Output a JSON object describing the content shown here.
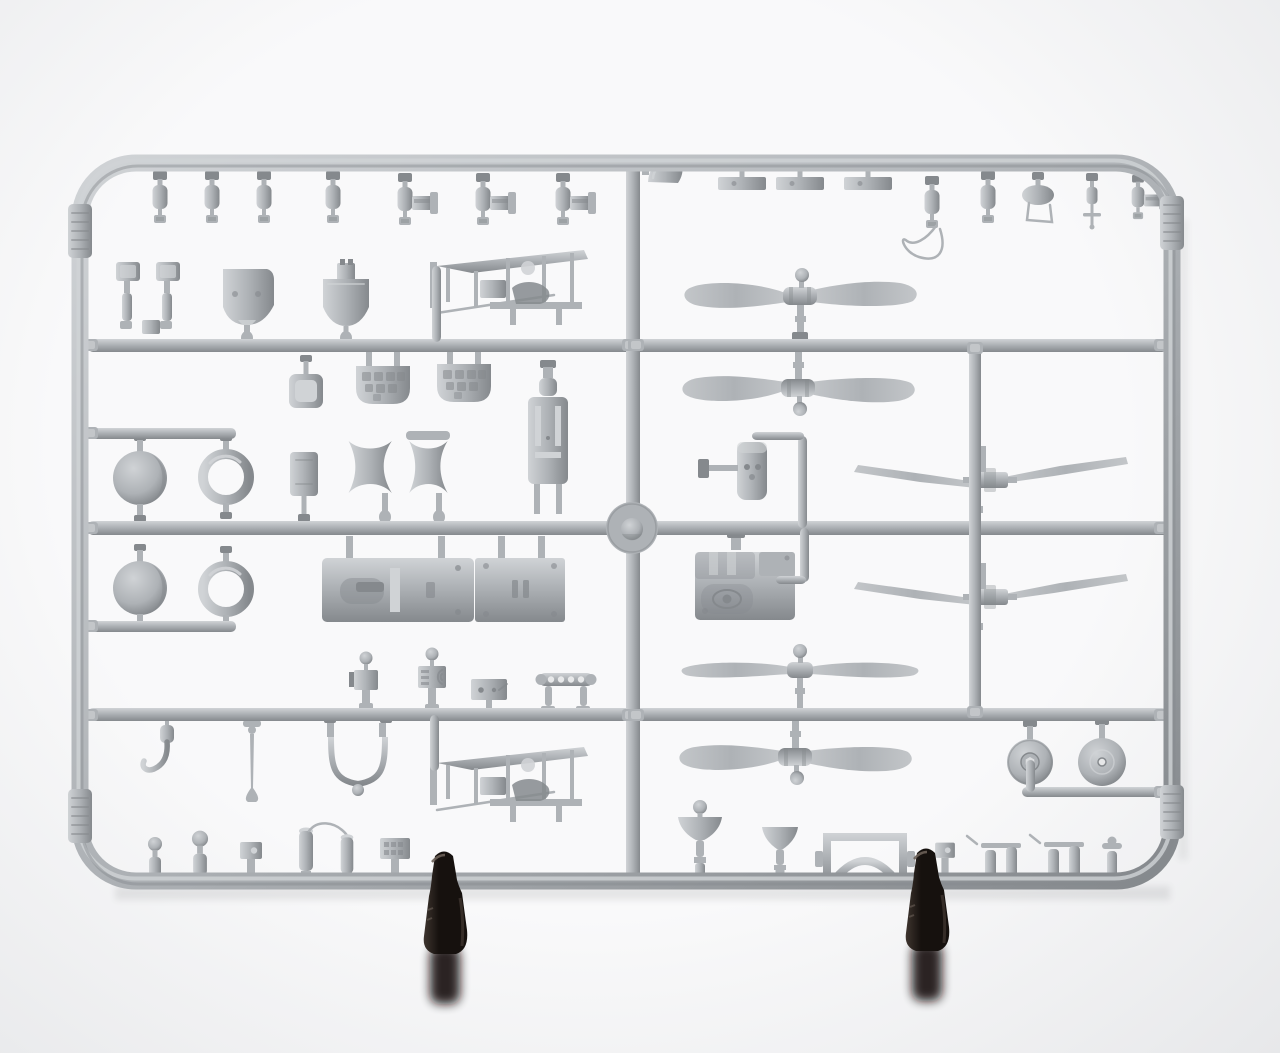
{
  "meta": {
    "description": "Photograph of a light-gray injection-molded plastic model aircraft sprue (parts frame) on a white background, held upright by two dark display clips at the bottom. The rectangular runner frame is divided by a central vertical runner and three horizontal runners; it carries propellers, spinner domes, cowling rings, bulkheads, instrument panels, an engine block, wheels, seats, guns and many small fittings."
  },
  "colors": {
    "background": "#f9f9fa",
    "vignette": "#e7e8ea",
    "plastic": "#aeb2b6",
    "plastic_light": "#d0d3d6",
    "plastic_dark": "#85898d",
    "plastic_deep": "#6e7276",
    "blade_light": "#c3c6c9",
    "clip_dark": "#16110e",
    "clip_mid": "#3e352f",
    "clip_light": "#6b6058",
    "shadow": "#3a3d40"
  },
  "inventory": [
    {
      "part": "small cylindrical fittings / pumps (top and bottom rows)",
      "count": 22
    },
    {
      "part": "machine guns with breech blocks",
      "count": 4
    },
    {
      "part": "windscreen",
      "count": 1
    },
    {
      "part": "flat mounting plates",
      "count": 3
    },
    {
      "part": "crew seat pair and seat backs",
      "count": 3
    },
    {
      "part": "firewall bulkheads",
      "count": 2
    },
    {
      "part": "instrument panels (textured)",
      "count": 2
    },
    {
      "part": "radiator panel stack",
      "count": 1
    },
    {
      "part": "spinner domes (balls)",
      "count": 2
    },
    {
      "part": "cowling rings",
      "count": 2
    },
    {
      "part": "cowl saddle halves with handle",
      "count": 1
    },
    {
      "part": "fuselage decking halves",
      "count": 2
    },
    {
      "part": "fuselage side girder frames",
      "count": 2
    },
    {
      "part": "engine block",
      "count": 1
    },
    {
      "part": "two-blade propellers (paddle type)",
      "count": 3
    },
    {
      "part": "two-blade propellers (slender pointed type)",
      "count": 2
    },
    {
      "part": "two-blade propeller (straight slim type)",
      "count": 1
    },
    {
      "part": "disc wheels",
      "count": 2
    },
    {
      "part": "venturi funnels",
      "count": 2
    },
    {
      "part": "arched bracket frame",
      "count": 1
    },
    {
      "part": "control stick, U-bracket, hook lever",
      "count": 3
    },
    {
      "part": "embossed frame tabs",
      "count": 4
    },
    {
      "part": "black display clips",
      "count": 2
    }
  ],
  "sprue": {
    "frame": {
      "x": 80,
      "y": 163,
      "width": 1092,
      "height": 718,
      "corner_radius": 56,
      "tube_width": 17
    },
    "runners": [
      {
        "x": 88,
        "y": 339,
        "w": 545,
        "h": 13,
        "o": "h"
      },
      {
        "x": 633,
        "y": 339,
        "w": 534,
        "h": 13,
        "o": "h"
      },
      {
        "x": 88,
        "y": 521,
        "w": 1082,
        "h": 14,
        "o": "h"
      },
      {
        "x": 88,
        "y": 708,
        "w": 545,
        "h": 13,
        "o": "h"
      },
      {
        "x": 633,
        "y": 708,
        "w": 534,
        "h": 13,
        "o": "h"
      },
      {
        "x": 626,
        "y": 166,
        "w": 14,
        "h": 716,
        "o": "v"
      },
      {
        "x": 969,
        "y": 345,
        "w": 12,
        "h": 372,
        "o": "v"
      },
      {
        "x": 88,
        "y": 428,
        "w": 148,
        "h": 11,
        "o": "h"
      },
      {
        "x": 88,
        "y": 621,
        "w": 148,
        "h": 11,
        "o": "h"
      },
      {
        "x": 1022,
        "y": 787,
        "w": 146,
        "h": 10,
        "o": "h"
      },
      {
        "x": 1026,
        "y": 760,
        "w": 9,
        "h": 32,
        "o": "v"
      },
      {
        "x": 798,
        "y": 436,
        "w": 9,
        "h": 92,
        "o": "v"
      },
      {
        "x": 752,
        "y": 432,
        "w": 52,
        "h": 8,
        "o": "h"
      },
      {
        "x": 800,
        "y": 528,
        "w": 9,
        "h": 54,
        "o": "v"
      },
      {
        "x": 776,
        "y": 576,
        "w": 30,
        "h": 8,
        "o": "h"
      },
      {
        "x": 432,
        "y": 266,
        "w": 9,
        "h": 76,
        "o": "v"
      },
      {
        "x": 430,
        "y": 715,
        "w": 9,
        "h": 56,
        "o": "v"
      }
    ],
    "gates": [
      {
        "x": 90,
        "y": 345
      },
      {
        "x": 630,
        "y": 345
      },
      {
        "x": 636,
        "y": 345
      },
      {
        "x": 1162,
        "y": 345
      },
      {
        "x": 90,
        "y": 528
      },
      {
        "x": 630,
        "y": 528
      },
      {
        "x": 636,
        "y": 528
      },
      {
        "x": 1162,
        "y": 528
      },
      {
        "x": 90,
        "y": 715
      },
      {
        "x": 630,
        "y": 715
      },
      {
        "x": 636,
        "y": 715
      },
      {
        "x": 1162,
        "y": 715
      },
      {
        "x": 975,
        "y": 348
      },
      {
        "x": 975,
        "y": 712
      },
      {
        "x": 90,
        "y": 433
      },
      {
        "x": 90,
        "y": 626
      },
      {
        "x": 1162,
        "y": 792
      }
    ],
    "placements": [
      {
        "s": "cylA",
        "name": "small-cylinder-part",
        "x": 160,
        "y": 197
      },
      {
        "s": "cylA",
        "name": "small-cylinder-part",
        "x": 212,
        "y": 197
      },
      {
        "s": "cylA",
        "name": "small-cylinder-part",
        "x": 264,
        "y": 197
      },
      {
        "s": "cylA",
        "name": "small-cylinder-part",
        "x": 333,
        "y": 197
      },
      {
        "s": "cylGun",
        "name": "machine-gun-part",
        "x": 405,
        "y": 199
      },
      {
        "s": "cylGun",
        "name": "machine-gun-part",
        "x": 483,
        "y": 199
      },
      {
        "s": "cylGun",
        "name": "machine-gun-part",
        "x": 563,
        "y": 199
      },
      {
        "s": "windscreen",
        "name": "windscreen-part",
        "x": 666,
        "y": 171
      },
      {
        "s": "plateTop",
        "name": "flat-plate-part",
        "x": 742,
        "y": 186
      },
      {
        "s": "plateTop",
        "name": "flat-plate-part",
        "x": 800,
        "y": 186
      },
      {
        "s": "plateTop",
        "name": "flat-plate-part",
        "x": 868,
        "y": 186
      },
      {
        "s": "cylWire",
        "name": "cylinder-with-wire-part",
        "x": 932,
        "y": 202
      },
      {
        "s": "cylA",
        "name": "small-cylinder-part",
        "x": 988,
        "y": 197
      },
      {
        "s": "pillWire",
        "name": "tank-with-bracket-part",
        "x": 1038,
        "y": 196
      },
      {
        "s": "cylCross",
        "name": "cylinder-with-cross-part",
        "x": 1092,
        "y": 200
      },
      {
        "s": "cylGun",
        "name": "machine-gun-part",
        "x": 1138,
        "y": 197,
        "sx": 0.85,
        "sy": 0.85
      },
      {
        "s": "seatPair",
        "name": "seat-pair-part",
        "x": 148,
        "y": 302
      },
      {
        "s": "bulkheadA",
        "name": "firewall-bulkhead-part",
        "x": 247,
        "y": 298
      },
      {
        "s": "bulkheadB",
        "name": "firewall-bulkhead-part",
        "x": 346,
        "y": 300
      },
      {
        "s": "truss",
        "name": "fuselage-girder-frame-part",
        "x": 512,
        "y": 286
      },
      {
        "s": "panPart",
        "name": "square-pan-part",
        "x": 306,
        "y": 392
      },
      {
        "s": "instrPanel",
        "name": "instrument-panel-part",
        "x": 383,
        "y": 386
      },
      {
        "s": "instrPanel",
        "name": "instrument-panel-part",
        "x": 464,
        "y": 384
      },
      {
        "s": "radiatorStack",
        "name": "radiator-panel-part",
        "x": 548,
        "y": 440
      },
      {
        "s": "sphere",
        "name": "spinner-dome-part",
        "x": 140,
        "y": 478
      },
      {
        "s": "sphere",
        "name": "spinner-dome-part",
        "x": 140,
        "y": 588
      },
      {
        "s": "ringPart",
        "name": "cowling-ring-part",
        "x": 226,
        "y": 477
      },
      {
        "s": "ringPart",
        "name": "cowling-ring-part",
        "x": 226,
        "y": 589
      },
      {
        "s": "smallPlateV",
        "name": "small-plate-part",
        "x": 304,
        "y": 474
      },
      {
        "s": "saddlePair",
        "name": "cowl-saddle-parts",
        "x": 428,
        "y": 467
      },
      {
        "s": "deckL",
        "name": "fuselage-decking-part",
        "x": 398,
        "y": 590
      },
      {
        "s": "deckR",
        "name": "fuselage-decking-part",
        "x": 520,
        "y": 590
      },
      {
        "s": "ballBox",
        "name": "fitting-with-ball-part",
        "x": 366,
        "y": 684
      },
      {
        "s": "radioBox",
        "name": "radio-box-part",
        "x": 432,
        "y": 682
      },
      {
        "s": "holePlate",
        "name": "drilled-plate-part",
        "x": 489,
        "y": 692
      },
      {
        "s": "hRail",
        "name": "rail-with-holes-part",
        "x": 566,
        "y": 688
      },
      {
        "s": "hookPart",
        "name": "hook-lever-part",
        "x": 167,
        "y": 744
      },
      {
        "s": "controlStick",
        "name": "control-stick-part",
        "x": 252,
        "y": 758
      },
      {
        "s": "uBracket",
        "name": "u-bracket-part",
        "x": 358,
        "y": 754
      },
      {
        "s": "truss",
        "name": "fuselage-girder-frame-part",
        "x": 512,
        "y": 783
      },
      {
        "s": "postBall",
        "name": "ball-top-fitting",
        "x": 155,
        "y": 866
      },
      {
        "s": "postBall",
        "name": "ball-top-fitting",
        "x": 200,
        "y": 864,
        "sx": 1.15,
        "sy": 1.15
      },
      {
        "s": "postBox",
        "name": "box-fitting",
        "x": 251,
        "y": 868
      },
      {
        "s": "postTallWire",
        "name": "tall-cylinder-with-wire",
        "x": 306,
        "y": 865
      },
      {
        "s": "postTall",
        "name": "tall-cylinder-fitting",
        "x": 347,
        "y": 868,
        "sx": 0.9,
        "sy": 0.9
      },
      {
        "s": "postPanelTex",
        "name": "textured-panel-fitting",
        "x": 395,
        "y": 870
      },
      {
        "s": "propPaddle",
        "name": "propeller-paddle",
        "x": 800,
        "y": 296
      },
      {
        "s": "propPaddle",
        "name": "propeller-paddle",
        "x": 798,
        "y": 388,
        "sy": -1
      },
      {
        "s": "propSlim",
        "name": "propeller-slim",
        "x": 800,
        "y": 670
      },
      {
        "s": "propPaddle",
        "name": "propeller-paddle",
        "x": 795,
        "y": 757,
        "sy": -1
      },
      {
        "s": "propThin",
        "name": "propeller-pointed",
        "x": 990,
        "y": 480
      },
      {
        "s": "propThin",
        "name": "propeller-pointed",
        "x": 990,
        "y": 597
      },
      {
        "s": "seatAsm",
        "name": "seat-back-assembly",
        "x": 752,
        "y": 472
      },
      {
        "s": "engineBlock",
        "name": "engine-block-part",
        "x": 745,
        "y": 586
      },
      {
        "s": "wheelHex",
        "name": "disc-wheel-hex-hub",
        "x": 1030,
        "y": 762
      },
      {
        "s": "wheelFlat",
        "name": "disc-wheel-plain",
        "x": 1102,
        "y": 762
      },
      {
        "s": "funnelBall",
        "name": "venturi-funnel-part",
        "x": 700,
        "y": 847
      },
      {
        "s": "funnelPlain",
        "name": "venturi-funnel-part",
        "x": 780,
        "y": 855
      },
      {
        "s": "archFrame",
        "name": "arched-bracket-part",
        "x": 865,
        "y": 859
      },
      {
        "s": "postBox",
        "name": "box-fitting",
        "x": 945,
        "y": 866,
        "sx": 0.9,
        "sy": 0.9
      },
      {
        "s": "sidearmPair",
        "name": "twin-cylinder-fitting",
        "x": 1001,
        "y": 866
      },
      {
        "s": "sidearmPair",
        "name": "twin-cylinder-fitting",
        "x": 1064,
        "y": 865
      },
      {
        "s": "postValve",
        "name": "valve-fitting",
        "x": 1112,
        "y": 869
      },
      {
        "s": "hubDisc",
        "name": "sprue-injection-hub",
        "x": 632,
        "y": 528,
        "layer": "top-layer"
      },
      {
        "s": "tab",
        "name": "embossed-frame-tab",
        "x": 80,
        "y": 231,
        "layer": "top-layer"
      },
      {
        "s": "tab",
        "name": "embossed-frame-tab",
        "x": 80,
        "y": 816,
        "layer": "top-layer"
      },
      {
        "s": "tab",
        "name": "embossed-frame-tab",
        "x": 1172,
        "y": 223,
        "layer": "top-layer"
      },
      {
        "s": "tab",
        "name": "embossed-frame-tab",
        "x": 1172,
        "y": 812,
        "layer": "top-layer"
      },
      {
        "s": "clip",
        "name": "display-clip",
        "x": 444,
        "y": 906,
        "layer": "clip-layer"
      },
      {
        "s": "clip",
        "name": "display-clip",
        "x": 926,
        "y": 903,
        "layer": "clip-layer"
      }
    ]
  }
}
